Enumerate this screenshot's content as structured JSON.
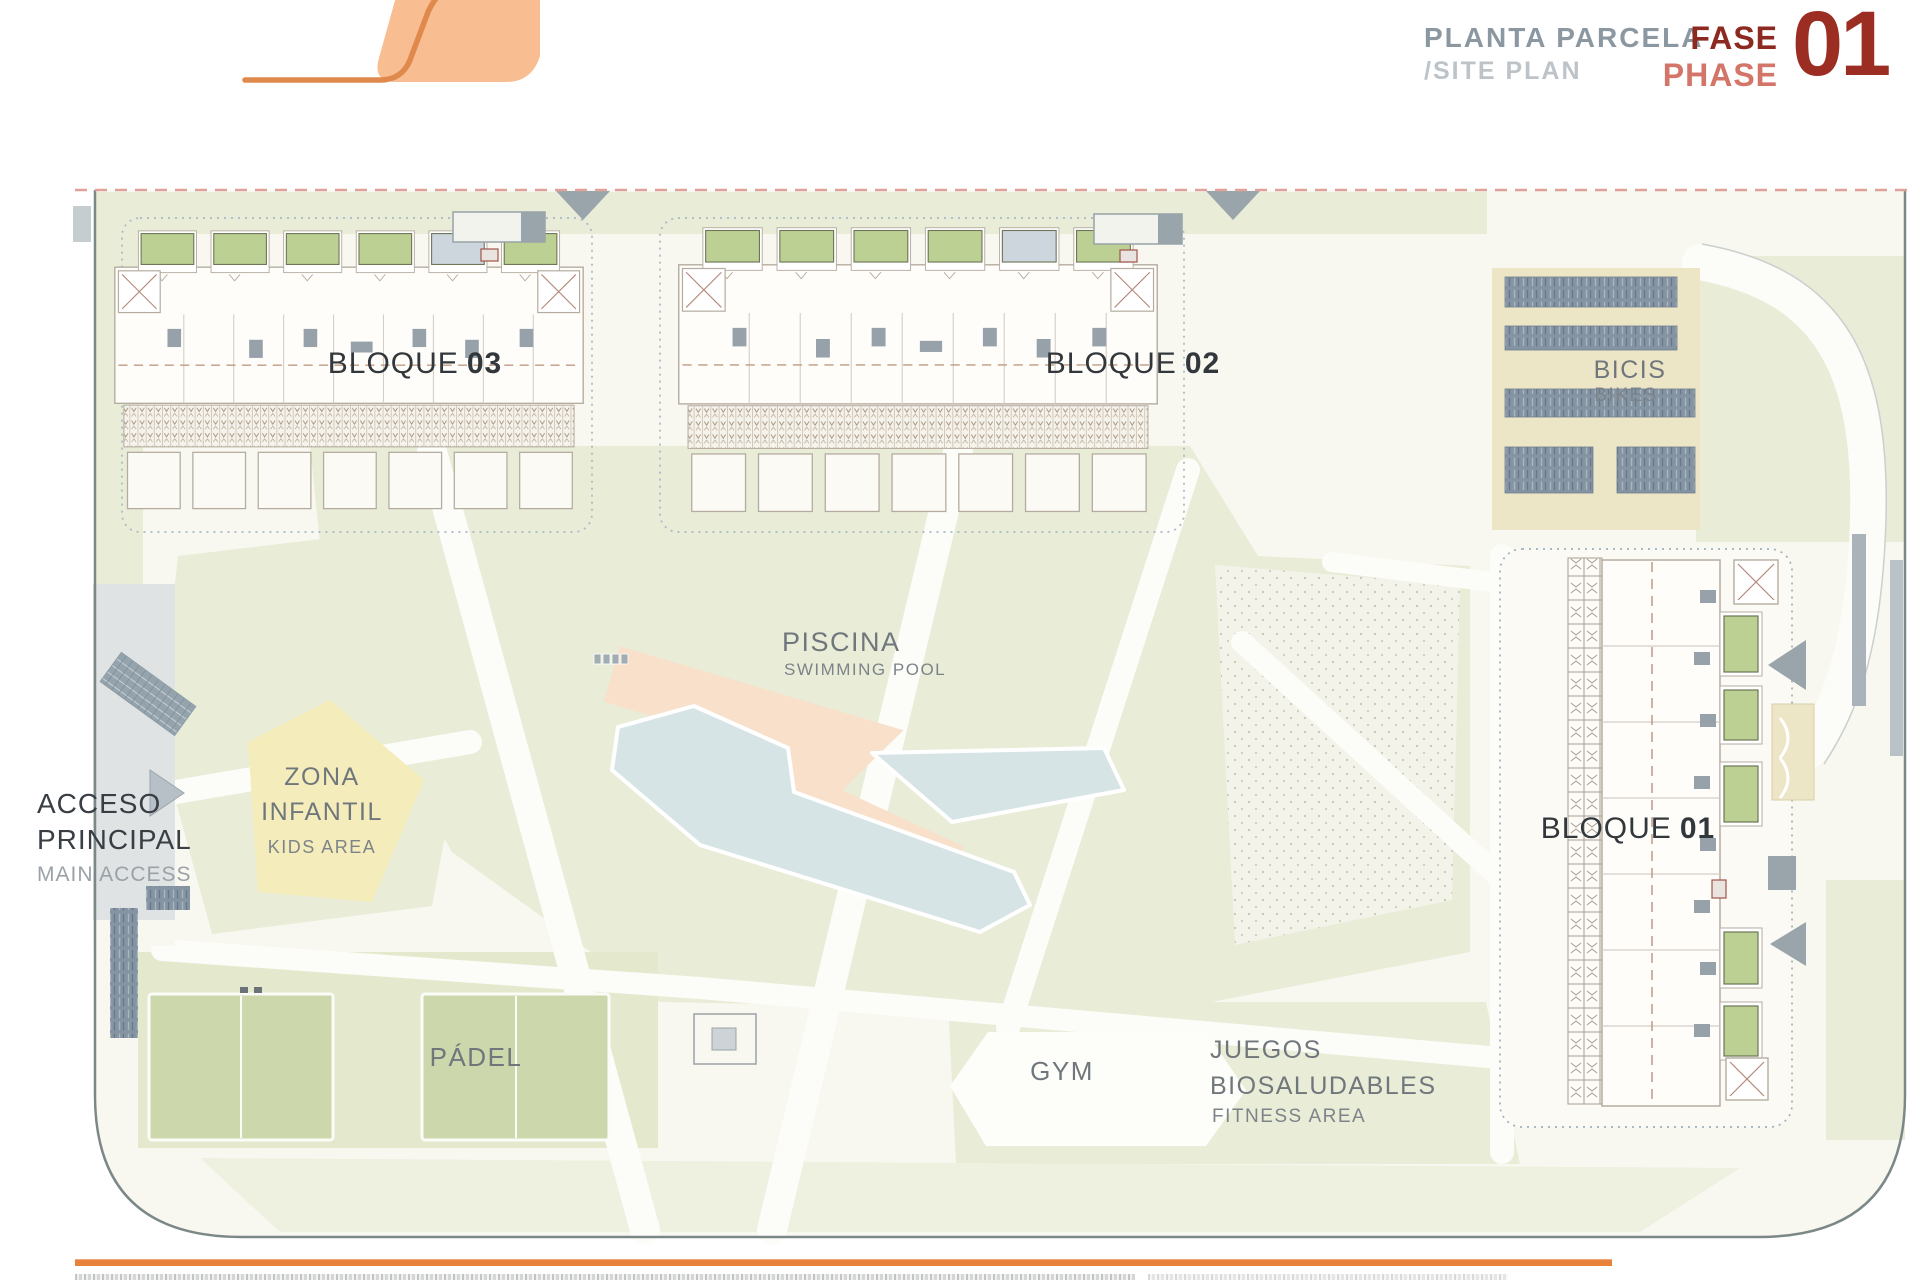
{
  "header": {
    "title": "PLANTA PARCELA",
    "subtitle": "/SITE PLAN",
    "phase": {
      "es": "FASE",
      "en": "PHASE",
      "number": "01"
    }
  },
  "blocks": {
    "b03": {
      "name": "BLOQUE",
      "number": "03"
    },
    "b02": {
      "name": "BLOQUE",
      "number": "02"
    },
    "b01": {
      "name": "BLOQUE",
      "number": "01"
    }
  },
  "labels": {
    "bikes": {
      "es": "BICIS",
      "en": "BIKES"
    },
    "pool": {
      "es": "PISCINA",
      "en": "SWIMMING POOL"
    },
    "kids": {
      "es1": "ZONA",
      "es2": "INFANTIL",
      "en": "KIDS AREA"
    },
    "access": {
      "es1": "ACCESO",
      "es2": "PRINCIPAL",
      "en": "MAIN ACCESS"
    },
    "padel": {
      "es": "PÁDEL"
    },
    "gym": {
      "es": "GYM"
    },
    "fitness": {
      "es1": "JUEGOS",
      "es2": "BIOSALUDABLES",
      "en": "FITNESS AREA"
    }
  },
  "colors": {
    "accent_orange": "#e7813c",
    "logo_fill": "#f9bd92",
    "logo_stroke": "#df8a4c",
    "phase_dark_red": "#9c2d23",
    "phase_salmon": "#d4756a",
    "title_gray": "#8c98a1",
    "lawn_green": "#e9ecd7",
    "pool_blue": "#d6e4e6",
    "deck_salmon": "#f8e0cb",
    "padel_green": "#ccd8ab",
    "bike_tan": "#ede6c6",
    "rack_bluegray": "#8494a2",
    "boundary_dash_pink": "#dfa29b"
  }
}
